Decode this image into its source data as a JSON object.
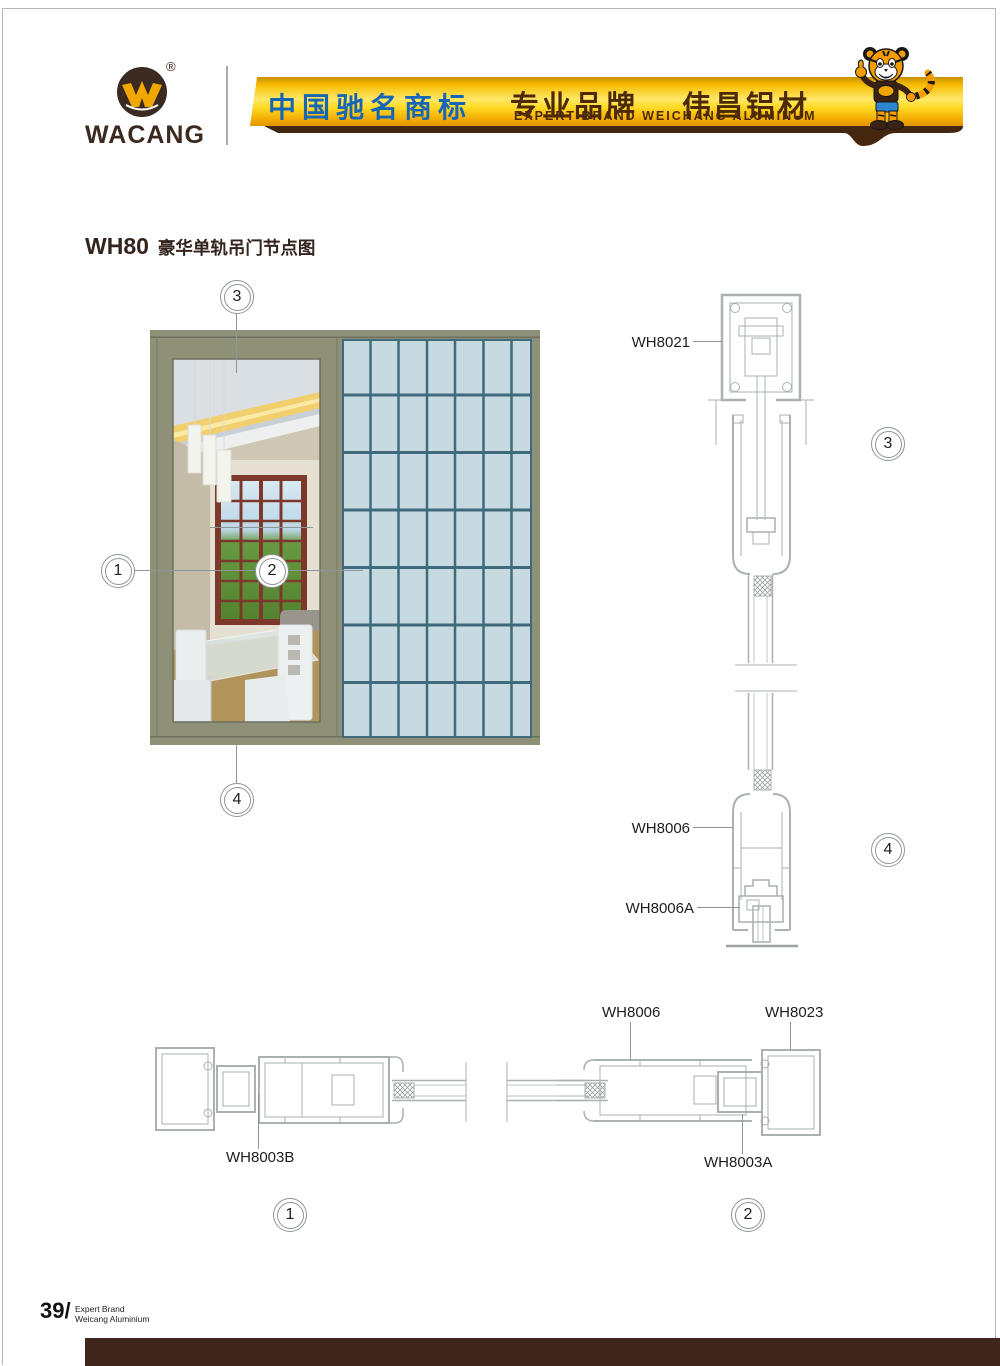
{
  "header": {
    "brand": "WACANG",
    "registered": "®",
    "banner": {
      "cn_left": "中国驰名商标",
      "cn_right_1": "专业品牌",
      "cn_right_2": "伟昌铝材",
      "en": "EXPERT BRAND WEICHANG ALUMINUM"
    }
  },
  "title": {
    "code": "WH80",
    "zh": "豪华单轨吊门节点图"
  },
  "callouts": {
    "n1": "1",
    "n2": "2",
    "n3": "3",
    "n4": "4"
  },
  "labels": {
    "wh8021": "WH8021",
    "wh8006_top": "WH8006",
    "wh8006a": "WH8006A",
    "wh8003b": "WH8003B",
    "wh8006_plan": "WH8006",
    "wh8023": "WH8023",
    "wh8003a": "WH8003A"
  },
  "footer": {
    "page_no": "39/",
    "tag_line1": "Expert Brand",
    "tag_line2": "Weicang Aluminium"
  },
  "colors": {
    "banner_gold": "#f5b800",
    "banner_text_blue": "#1766b6",
    "banner_text_brown": "#4c2a06",
    "banner_base_brown": "#45260e",
    "frame_olive": "#8e9077",
    "glass_blue": "#c7dae1",
    "glass_mullion": "#3f6a7c",
    "drawing_line": "#aab1af",
    "footer_bar_brown": "#40251d",
    "brand_brown": "#3a2a20"
  }
}
